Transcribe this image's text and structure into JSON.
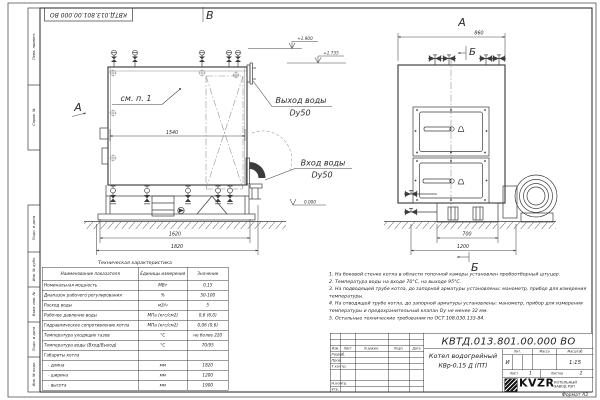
{
  "sheet": {
    "drawing_number": "КВТД.013.801.00.000 ВО",
    "format": "Формат А3"
  },
  "frame_labels": [
    "Перв. примен.",
    "Справ. №",
    "Подп. и дата",
    "Инв. № дубл.",
    "Взам. инв. №",
    "Подп. и дата",
    "Инв. № подл."
  ],
  "views": {
    "front": {
      "view_label": "В",
      "arrow_label": "А",
      "see_note": "см. п. 1",
      "outlet_line1": "Выход воды",
      "outlet_line2": "Dy50",
      "inlet_line1": "Вход воды",
      "inlet_line2": "Dy50",
      "elev1": "+1.900",
      "elev2": "+1.735",
      "elev0": "0.000",
      "dim_inner": "1540",
      "dim_frame": "1620",
      "dim_total": "1820"
    },
    "side": {
      "view_label": "А",
      "section_label": "Б",
      "section_label_bottom": "Б",
      "dim_top": "860",
      "dim_base": "700",
      "dim_total": "1200"
    }
  },
  "tech_table": {
    "title": "Техническая характеристика",
    "col_name": "Наименование показателя",
    "col_units": "Единицы измерения",
    "col_value": "Значение",
    "rows": [
      [
        "Номинальная мощность",
        "МВт",
        "0,15"
      ],
      [
        "Диапазон рабочего регулирования",
        "%",
        "50-100"
      ],
      [
        "Расход воды",
        "м3/ч",
        "5"
      ],
      [
        "Рабочее давление воды",
        "МПа (кгс/см2)",
        "0,6 (6,0)"
      ],
      [
        "Гидравлическое сопротивление котла",
        "МПа (кгс/см2)",
        "0,06 (0,6)"
      ],
      [
        "Температура уходящих газов",
        "°С",
        "не более 220"
      ],
      [
        "Температура воды (Вход/Выход)",
        "°С",
        "70/95"
      ],
      [
        "Габариты котла",
        "",
        ""
      ],
      [
        "   - длина",
        "мм",
        "1820"
      ],
      [
        "   - ширина",
        "мм",
        "1200"
      ],
      [
        "   - высота",
        "мм",
        "1900"
      ]
    ]
  },
  "notes": [
    "1.  На боковой стенке котла в области топочной камеры установлен пробоотборный штуцер.",
    "2.  Температура воды на входе 70°С, на выходе 95°С.",
    "3.  На подводящей трубе котла, до запорной арматуры установлены: манометр, прибор для измерения температуры.",
    "4.  На отводящей трубе котла, до запорной арматуры установлены: манометр, прибор для измерения температуры и предохранительный клапан Dу не менее 32 мм.",
    "5.  Остальные технические требования по ОСТ 108.030.133-84."
  ],
  "title_block": {
    "doc_number": "КВТД.013.801.00.000 ВО",
    "name_line1": "Котел водогрейный",
    "name_line2": "КВр-0,15 Д  (ПТ)",
    "cols": [
      "Изм.",
      "Лист",
      "N докум.",
      "Подп.",
      "Дата"
    ],
    "sig_rows": [
      "Разраб.",
      "Пров.",
      "Т.контр.",
      "Н.контр.",
      "Утв."
    ],
    "lit_label": "Лит.",
    "lit_value": "И",
    "mass_label": "Масса",
    "scale_label": "Масштаб",
    "scale_value": "1:15",
    "sheet_label": "Лист",
    "sheet_value": "1",
    "sheets_label": "Листов",
    "sheets_value": "2",
    "logo_text": "KVZR",
    "company_line1": "КОТЕЛЬНЫЙ",
    "company_line2": "ЗАВОД РЭП"
  }
}
